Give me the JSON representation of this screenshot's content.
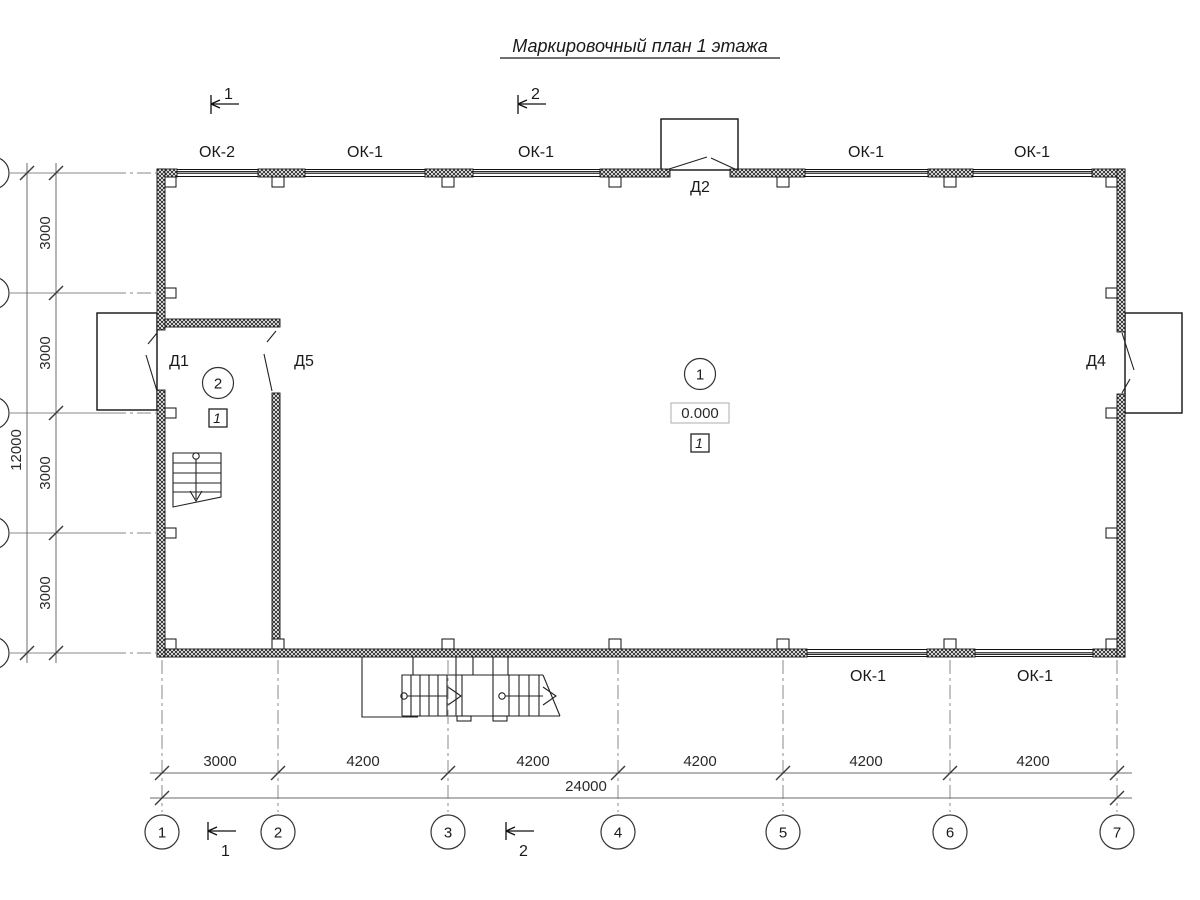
{
  "title": "Маркировочный план 1 этажа",
  "section_marks": {
    "top": [
      "1",
      "2"
    ],
    "bottom": [
      "1",
      "2"
    ]
  },
  "windows": {
    "top_labels": [
      "ОК-2",
      "ОК-1",
      "ОК-1",
      "ОК-1",
      "ОК-1"
    ],
    "bottom_labels": [
      "ОК-1",
      "ОК-1"
    ]
  },
  "doors": {
    "d1": "Д1",
    "d5": "Д5",
    "d2": "Д2",
    "d4": "Д4"
  },
  "rooms": {
    "main": {
      "number": "1",
      "elevation": "0.000",
      "type_tag": "1"
    },
    "stair": {
      "number": "2",
      "type_tag": "1"
    }
  },
  "dimensions": {
    "left": {
      "segments": [
        "3000",
        "3000",
        "3000",
        "3000"
      ],
      "total": "12000"
    },
    "bottom": {
      "segments": [
        "3000",
        "4200",
        "4200",
        "4200",
        "4200",
        "4200"
      ],
      "total": "24000"
    }
  },
  "axes": {
    "numbers": [
      "1",
      "2",
      "3",
      "4",
      "5",
      "6",
      "7"
    ]
  }
}
